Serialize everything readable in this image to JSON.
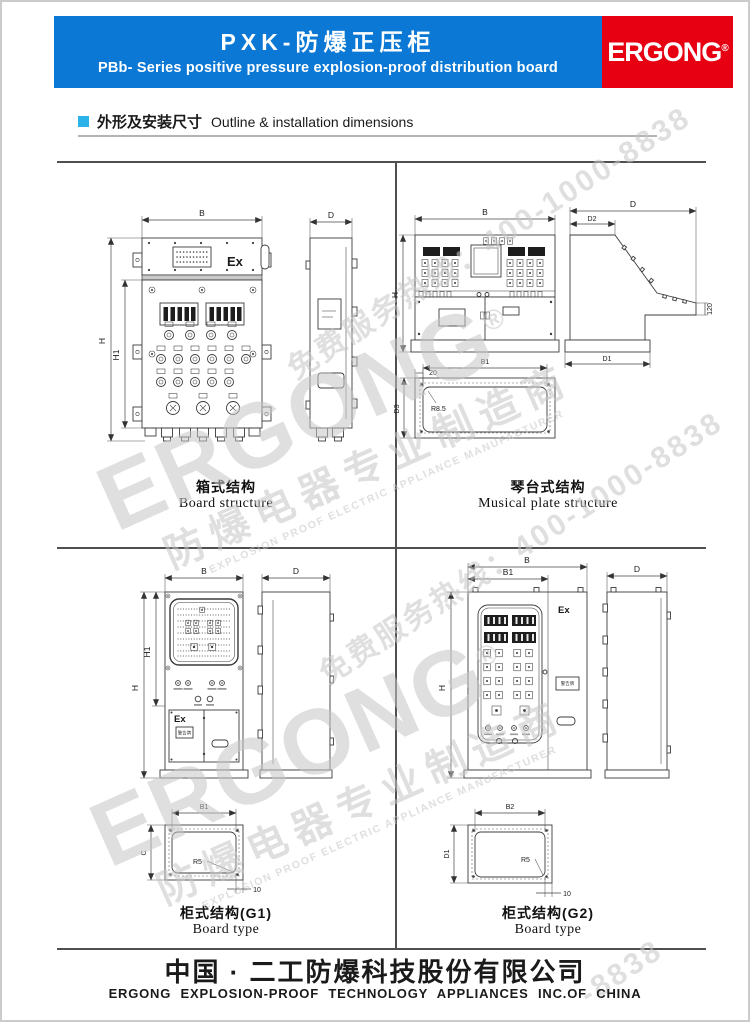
{
  "header": {
    "title_zh": "PXK-防爆正压柜",
    "title_en": "PBb- Series positive pressure explosion-proof distribution board",
    "brand": "ERGONG",
    "reg": "®"
  },
  "section": {
    "title_zh": "外形及安装尺寸",
    "title_en": "Outline & installation dimensions"
  },
  "colors": {
    "header_blue": "#0a78d4",
    "brand_red": "#e60012",
    "bullet_blue": "#2bb3e9",
    "frame_gray": "#4f4f4f",
    "watermark_gray": "#c6c6c6"
  },
  "drawings": {
    "board": {
      "caption_zh": "箱式结构",
      "caption_en": "Board structure",
      "ex": "Ex",
      "dims": {
        "b": "B",
        "h": "H",
        "h1": "H1",
        "d": "D"
      }
    },
    "musical": {
      "caption_zh": "琴台式结构",
      "caption_en": "Musical plate structure",
      "dims": {
        "b": "B",
        "h": "H",
        "d": "D",
        "d1": "D1",
        "d2": "D2",
        "d3": "D3",
        "b1": "B1",
        "off": "20",
        "r": "R8.5",
        "ht": "120"
      }
    },
    "g1": {
      "caption_zh": "柜式结构(G1)",
      "caption_en": "Board type",
      "ex": "Ex",
      "plate": "警告牌",
      "dims": {
        "b": "B",
        "h": "H",
        "h1": "H1",
        "d": "D",
        "b1": "B1",
        "c": "C",
        "r": "R5",
        "off": "10"
      }
    },
    "g2": {
      "caption_zh": "柜式结构(G2)",
      "caption_en": "Board type",
      "ex": "Ex",
      "plate": "警告牌",
      "dims": {
        "b": "B",
        "b1": "B1",
        "h": "H",
        "d": "D",
        "b2": "B2",
        "d1": "D1",
        "r": "R5",
        "off": "10"
      }
    }
  },
  "watermark": {
    "brand": "ERGONG",
    "reg": "®",
    "zh": "防爆电器专业制造商",
    "en": "EXPLOSION PROOF ELECTRIC APPLIANCE MANUFACTURER",
    "hotline": "免费服务热线：400-1000-8838",
    "hotline_tail": "-8838"
  },
  "footer": {
    "company_zh": "中国 · 二工防爆科技股份有限公司",
    "company_en": "ERGONG EXPLOSION-PROOF TECHNOLOGY APPLIANCES INC.OF CHINA"
  }
}
